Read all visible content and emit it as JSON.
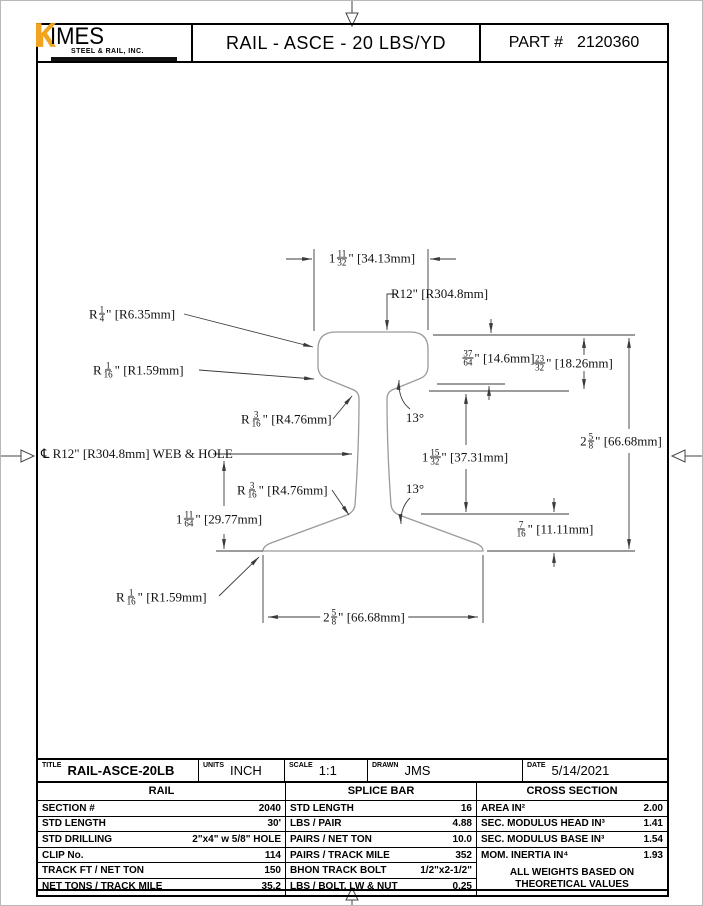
{
  "header": {
    "logo": {
      "k": "K",
      "name": "IMES",
      "subtitle": "STEEL & RAIL, INC.",
      "orange": "#F2A41F"
    },
    "title": "RAIL - ASCE - 20 LBS/YD",
    "part_label": "PART #",
    "part_number": "2120360"
  },
  "drawing": {
    "labels": [
      {
        "id": "head-width",
        "x": 371,
        "y": 257,
        "anchor": "center",
        "pre": "1",
        "num": "11",
        "den": "32",
        "post": "\" [34.13mm]"
      },
      {
        "id": "head-top-radius",
        "x": 390,
        "y": 293,
        "anchor": "left",
        "pre": "R12",
        "post": "\" [R304.8mm]"
      },
      {
        "id": "head-corner-radius",
        "x": 88,
        "y": 313,
        "anchor": "left",
        "pre": "R",
        "num": "1",
        "den": "4",
        "post": "\" [R6.35mm]"
      },
      {
        "id": "head-lower-radius",
        "x": 92,
        "y": 369,
        "anchor": "left",
        "pre": "R",
        "num": "1",
        "den": "16",
        "post": "\" [R1.59mm]"
      },
      {
        "id": "web-fillet-top",
        "x": 240,
        "y": 418,
        "anchor": "left",
        "pre": "R",
        "num": "3",
        "den": "16",
        "post": "\" [R4.76mm]"
      },
      {
        "id": "web-hole-centerline",
        "x": 40,
        "y": 453,
        "anchor": "left",
        "pre": "℄ R12",
        "post": "\" [R304.8mm] WEB & HOLE"
      },
      {
        "id": "web-fillet-bottom",
        "x": 236,
        "y": 489,
        "anchor": "left",
        "pre": "R",
        "num": "3",
        "den": "16",
        "post": "\" [R4.76mm]"
      },
      {
        "id": "base-half-height",
        "x": 218,
        "y": 518,
        "anchor": "center",
        "pre": "1",
        "num": "11",
        "den": "64",
        "post": "\" [29.77mm]"
      },
      {
        "id": "head-depth",
        "x": 497,
        "y": 357,
        "anchor": "center",
        "pre": "",
        "num": "37",
        "den": "64",
        "post": "\" [14.6mm]"
      },
      {
        "id": "head-height",
        "x": 572,
        "y": 362,
        "anchor": "center",
        "pre": "",
        "num": "23",
        "den": "32",
        "post": "\" [18.26mm]"
      },
      {
        "id": "rail-height",
        "x": 620,
        "y": 440,
        "anchor": "center",
        "pre": "2",
        "num": "5",
        "den": "8",
        "post": "\" [66.68mm]"
      },
      {
        "id": "web-height",
        "x": 464,
        "y": 456,
        "anchor": "center",
        "pre": "1",
        "num": "15",
        "den": "32",
        "post": "\" [37.31mm]"
      },
      {
        "id": "web-angle-top",
        "x": 414,
        "y": 417,
        "anchor": "center",
        "pre": "13°"
      },
      {
        "id": "web-angle-bottom",
        "x": 414,
        "y": 488,
        "anchor": "center",
        "pre": "13°"
      },
      {
        "id": "base-edge-height",
        "x": 553,
        "y": 528,
        "anchor": "center",
        "pre": "",
        "num": "7",
        "den": "16",
        "post": "\" [11.11mm]"
      },
      {
        "id": "base-width",
        "x": 363,
        "y": 616,
        "anchor": "center",
        "bg": true,
        "pre": "2",
        "num": "5",
        "den": "8",
        "post": "\" [66.68mm]"
      },
      {
        "id": "base-corner-radius",
        "x": 115,
        "y": 596,
        "anchor": "left",
        "pre": "R",
        "num": "1",
        "den": "16",
        "post": "\" [R1.59mm]"
      }
    ]
  },
  "title_block": {
    "fields": [
      {
        "label": "TITLE",
        "value": "RAIL-ASCE-20LB"
      },
      {
        "label": "UNITS",
        "value": "INCH"
      },
      {
        "label": "SCALE",
        "value": "1:1"
      },
      {
        "label": "DRAWN",
        "value": "JMS"
      },
      {
        "label": "DATE",
        "value": "5/14/2021"
      }
    ]
  },
  "tables": {
    "rail": {
      "header": "RAIL",
      "rows": [
        [
          "SECTION #",
          "2040"
        ],
        [
          "STD LENGTH",
          "30'"
        ],
        [
          "STD DRILLING",
          "2\"x4\" w 5/8\" HOLE"
        ],
        [
          "CLIP No.",
          "114"
        ],
        [
          "TRACK FT / NET TON",
          "150"
        ],
        [
          "NET TONS / TRACK MILE",
          "35.2"
        ]
      ]
    },
    "splice": {
      "header": "SPLICE BAR",
      "rows": [
        [
          "STD LENGTH",
          "16"
        ],
        [
          "LBS / PAIR",
          "4.88"
        ],
        [
          "PAIRS / NET TON",
          "10.0"
        ],
        [
          "PAIRS / TRACK MILE",
          "352"
        ],
        [
          "BHON TRACK BOLT",
          "1/2\"x2-1/2\""
        ],
        [
          "LBS / BOLT, LW & NUT",
          "0.25"
        ]
      ]
    },
    "cross": {
      "header": "CROSS SECTION",
      "rows": [
        [
          "AREA IN²",
          "2.00"
        ],
        [
          "SEC. MODULUS HEAD IN³",
          "1.41"
        ],
        [
          "SEC. MODULUS BASE IN³",
          "1.54"
        ],
        [
          "MOM. INERTIA IN⁴",
          "1.93"
        ]
      ],
      "note_line1": "ALL WEIGHTS BASED ON",
      "note_line2": "THEORETICAL VALUES"
    }
  }
}
